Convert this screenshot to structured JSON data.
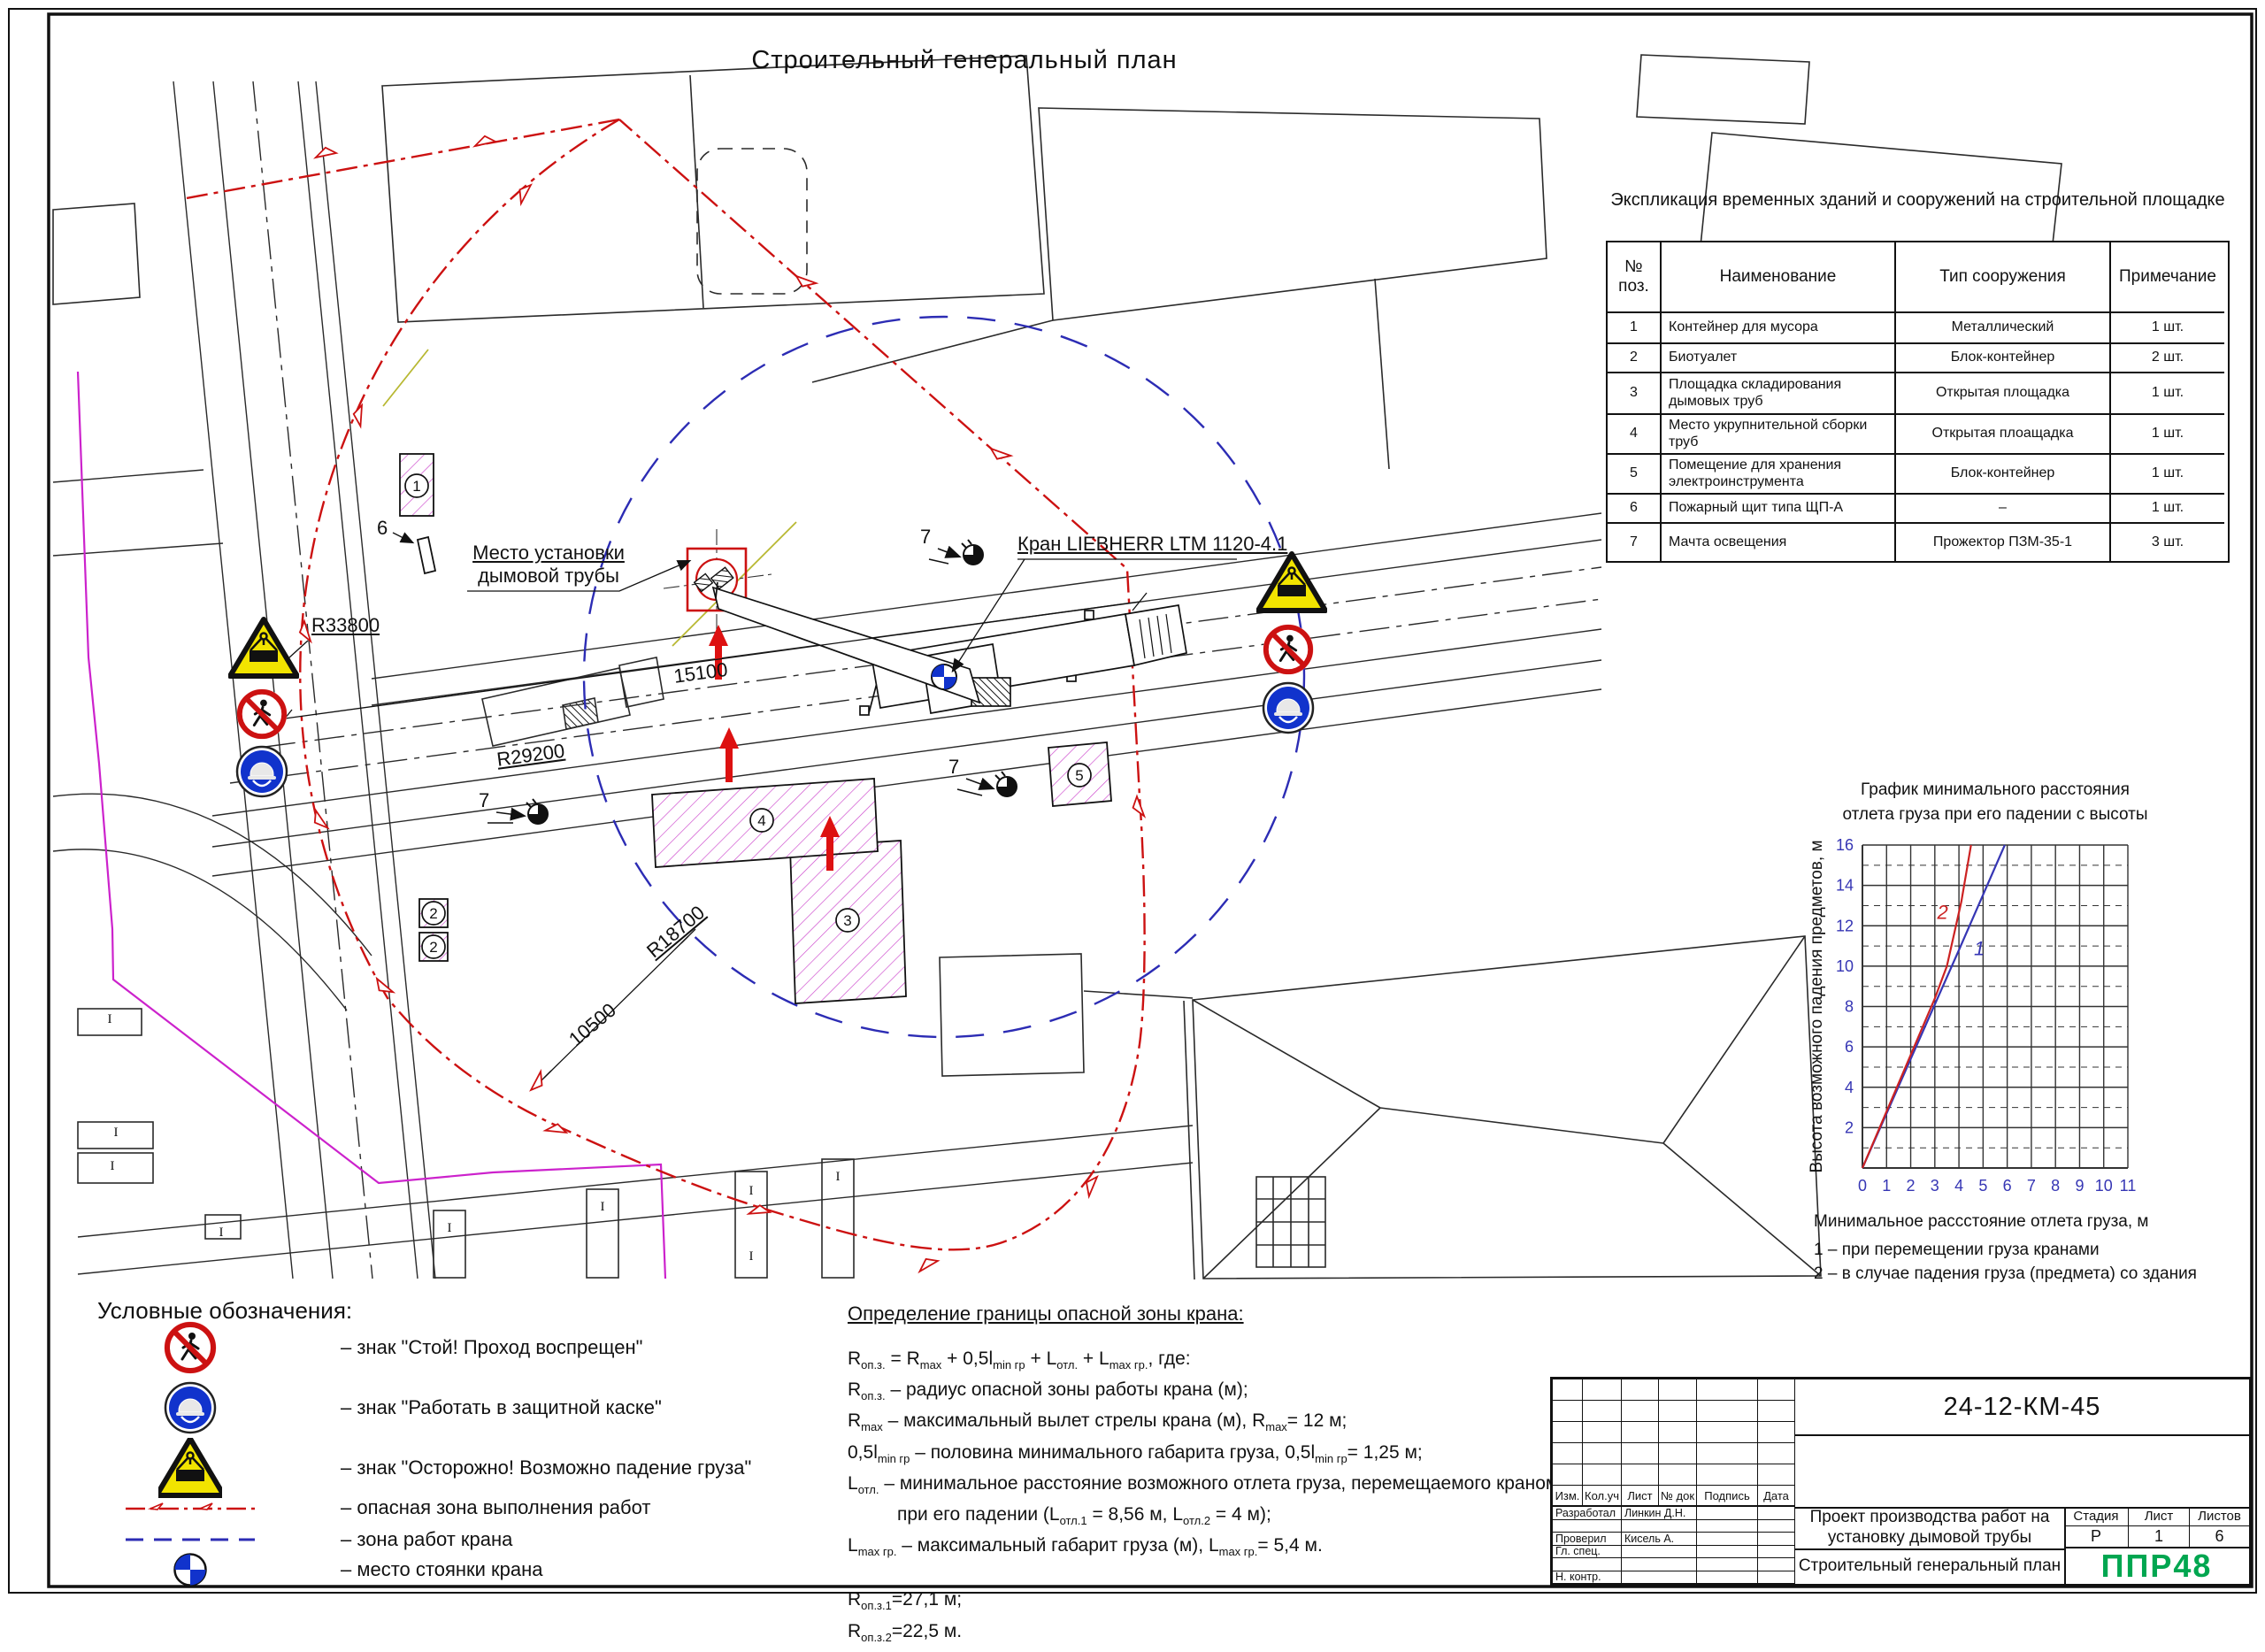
{
  "sheet": {
    "title": "Строительный генеральный план"
  },
  "expl_table": {
    "title": "Экспликация временных зданий и сооружений на строительной площадке",
    "columns": [
      "№ поз.",
      "Наименование",
      "Тип сооружения",
      "Примечание"
    ],
    "rows": [
      [
        "1",
        "Контейнер для мусора",
        "Металлический",
        "1 шт."
      ],
      [
        "2",
        "Биотуалет",
        "Блок-контейнер",
        "2 шт."
      ],
      [
        "3",
        "Площадка складирования дымовых труб",
        "Открытая площадка",
        "1 шт."
      ],
      [
        "4",
        "Место укрупнительной сборки труб",
        "Открытая плоащадка",
        "1 шт."
      ],
      [
        "5",
        "Помещение для хранения электроинструмента",
        "Блок-контейнер",
        "1 шт."
      ],
      [
        "6",
        "Пожарный щит типа ЩП-А",
        "–",
        "1 шт."
      ],
      [
        "7",
        "Мачта освещения",
        "Прожектор ПЗМ-35-1",
        "3 шт."
      ]
    ]
  },
  "chart_data": {
    "type": "line",
    "title_lines": [
      "График минимального расстояния",
      "отлета груза при его падении с высоты"
    ],
    "xlabel": "Минимальное рассстояние отлета груза, м",
    "ylabel": "Высота возможного падения предметов, м",
    "xlim": [
      0,
      11
    ],
    "ylim": [
      0,
      16
    ],
    "x_ticks": [
      0,
      1,
      2,
      3,
      4,
      5,
      6,
      7,
      8,
      9,
      10,
      11
    ],
    "y_ticks_labeled": [
      2,
      4,
      6,
      8,
      10,
      12,
      14,
      16
    ],
    "grid": "solid vertical each 1 m; horizontal solid at even, dashed at odd heights",
    "series": [
      {
        "name": "1",
        "note": "при перемещении груза кранами",
        "color": "#3636b4",
        "points": [
          [
            0,
            0
          ],
          [
            4,
            10.8
          ],
          [
            5.9,
            16
          ]
        ],
        "label_pos": [
          4.62,
          10.55
        ]
      },
      {
        "name": "2",
        "note": "в случае падения груза (предмета) со здания",
        "color": "#cc2222",
        "points": [
          [
            0,
            0
          ],
          [
            3,
            8.4
          ],
          [
            3.5,
            10
          ],
          [
            4.1,
            13.2
          ],
          [
            4.5,
            16
          ]
        ],
        "label_pos": [
          3.1,
          12.35
        ]
      }
    ],
    "footnotes": [
      "1 – при перемещении груза кранами",
      "2 – в случае падения груза (предмета) со здания"
    ]
  },
  "legend": {
    "title": "Условные обозначения:",
    "items": [
      {
        "icon": "no-pedestrian-sign",
        "label": "– знак \"Стой! Проход воспрещен\""
      },
      {
        "icon": "helmet-sign",
        "label": "– знак \"Работать в защитной каске\""
      },
      {
        "icon": "falling-load-sign",
        "label": "– знак \"Осторожно! Возможно падение груза\""
      },
      {
        "icon": "danger-zone-line",
        "label": "– опасная зона выполнения работ"
      },
      {
        "icon": "crane-zone-line",
        "label": "– зона работ крана"
      },
      {
        "icon": "crane-parking-symbol",
        "label": "– место стоянки крана"
      }
    ]
  },
  "calc": {
    "title": "Определение границы опасной зоны крана:",
    "lines": [
      {
        "segs": [
          "R",
          "оп.з.",
          " = R",
          "max",
          " + 0,5l",
          "min гр",
          " + L",
          "отл.",
          " + L",
          "max гр.",
          ", где:"
        ]
      },
      {
        "segs": [
          "R",
          "оп.з.",
          " – радиус опасной зоны работы крана (м);"
        ]
      },
      {
        "segs": [
          "R",
          "max",
          " – максимальный вылет стрелы крана (м), R",
          "max",
          "= 12 м;"
        ]
      },
      {
        "segs": [
          "0,5l",
          "min гр",
          " – половина минимального габарита груза, 0,5l",
          "min гр",
          "= 1,25 м;"
        ]
      },
      {
        "segs": [
          "L",
          "отл.",
          " – минимальное расстояние возможного отлета груза, перемещаемого краном,"
        ]
      },
      {
        "segs": [
          "при его падении (L",
          "отл.1",
          " = 8,56 м, L",
          "отл.2",
          " = 4 м);"
        ],
        "indent": true
      },
      {
        "segs": [
          "L",
          "max гр.",
          " – максимальный габарит груза (м), L",
          "max гр.",
          "= 5,4 м."
        ]
      }
    ],
    "results": [
      {
        "segs": [
          "R",
          "оп.з.1",
          "=27,1 м;"
        ]
      },
      {
        "segs": [
          "R",
          "оп.з.2",
          "=22,5 м."
        ]
      }
    ]
  },
  "titleblock": {
    "doc_number": "24-12-КМ-45",
    "header_cells": [
      "Изм.",
      "Кол.уч",
      "Лист",
      "№ док",
      "Подпись",
      "Дата"
    ],
    "roles": [
      {
        "label": "Разработал",
        "name": "Линкин Д.Н."
      },
      {
        "label": "",
        "name": ""
      },
      {
        "label": "Проверил",
        "name": "Кисель А."
      },
      {
        "label": "Гл. спец.",
        "name": ""
      },
      {
        "label": "",
        "name": ""
      },
      {
        "label": "Н. контр.",
        "name": ""
      }
    ],
    "project": "Проект производства работ на установку дымовой трубы",
    "sheet_name": "Строительный генеральный план",
    "stage_label": "Стадия",
    "sheet_label": "Лист",
    "sheets_label": "Листов",
    "stage": "Р",
    "sheet": "1",
    "sheets": "6",
    "logo": "ППР48",
    "logo_color": "#00a650"
  },
  "plan": {
    "labels": {
      "chimney_line1": "Место установки",
      "chimney_line2": "дымовой трубы",
      "crane": "Кран LIEBHERR LTM 1120-4.1",
      "r33800": "R33800",
      "r29200": "R29200",
      "r18700": "R18700",
      "dim_15100": "15100",
      "dim_10500": "10500",
      "fire_shield_no": "6"
    },
    "position_markers": [
      {
        "n": "1",
        "x": 471,
        "y": 549
      },
      {
        "n": "2",
        "x": 490,
        "y": 1032
      },
      {
        "n": "2",
        "x": 490,
        "y": 1070
      },
      {
        "n": "3",
        "x": 958,
        "y": 1040
      },
      {
        "n": "4",
        "x": 861,
        "y": 927
      },
      {
        "n": "5",
        "x": 1220,
        "y": 876
      }
    ],
    "signs": [
      {
        "type": "falling-load",
        "x": 298,
        "y": 733
      },
      {
        "type": "no-pedestrian",
        "x": 296,
        "y": 807
      },
      {
        "type": "helmet",
        "x": 296,
        "y": 872
      },
      {
        "type": "falling-load",
        "x": 1460,
        "y": 659
      },
      {
        "type": "no-pedestrian",
        "x": 1456,
        "y": 734
      },
      {
        "type": "helmet",
        "x": 1456,
        "y": 800
      }
    ],
    "masts": [
      {
        "label": "7",
        "label_x": 1040,
        "label_y": 592,
        "x": 1100,
        "y": 627
      },
      {
        "label": "7",
        "label_x": 1072,
        "label_y": 852,
        "x": 1138,
        "y": 889
      },
      {
        "label": "7",
        "label_x": 541,
        "label_y": 890,
        "x": 608,
        "y": 920
      }
    ],
    "colors": {
      "danger_zone": "#cc1111",
      "crane_zone": "#2c2cb4",
      "site_boundary": "#cc22cc",
      "hatch": "#cc44cc"
    }
  }
}
